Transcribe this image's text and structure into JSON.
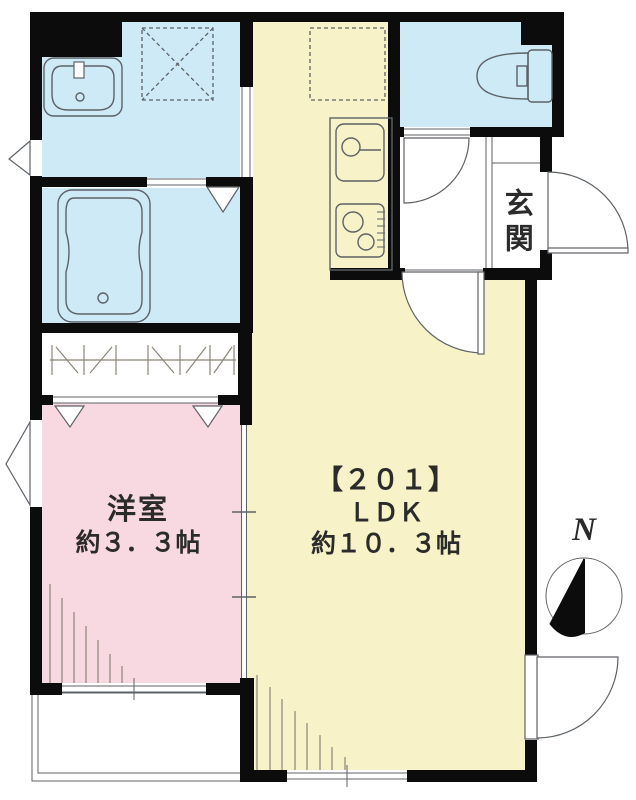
{
  "rooms": {
    "ldk": {
      "unit": "【２０１】",
      "name": "ＬＤＫ",
      "size": "約１０．３帖"
    },
    "western_room": {
      "name": "洋室",
      "size": "約３．３帖"
    },
    "entrance": {
      "name": "玄関"
    }
  },
  "compass": {
    "north": "N"
  },
  "colors": {
    "wall": "#0c0c0c",
    "wet_area": "#cdeaf6",
    "living_area": "#f8f2c9",
    "bedroom": "#f9d9e1",
    "line": "#5d6266",
    "hatch": "#8c8577",
    "text": "#2b2b2b",
    "background": "#ffffff"
  }
}
